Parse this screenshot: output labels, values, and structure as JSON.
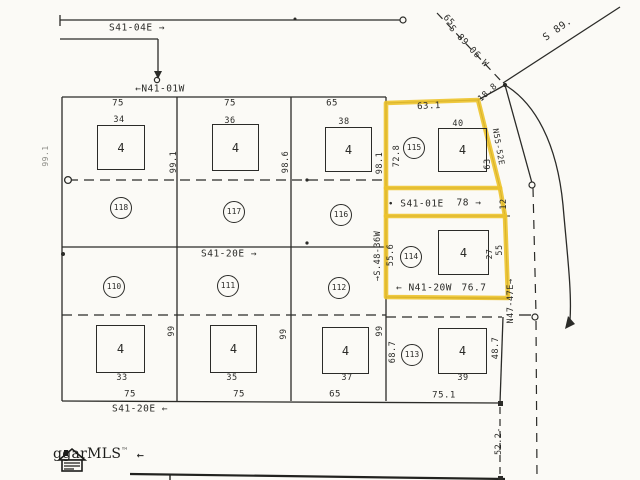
{
  "plat": {
    "colors": {
      "line": "#2b2b28",
      "highlight": "#edc32b",
      "paper": "#fbfaf6",
      "faint": "#8a8a84"
    },
    "logo": {
      "text": "ggarMLS",
      "tm": "™",
      "arrow": "←"
    },
    "street_bearings": {
      "top": "S41-04E →",
      "upper": "←N41-01W",
      "mid_road_dot": "•",
      "mid_road": "S41-01E",
      "mid_road_dist": "78 →",
      "mid": "S41-20E →",
      "lower_road": "← N41-20W",
      "lower_road_dist": "76.7",
      "bottom": "S41-20E ←",
      "ne_dashed": "S 89-06 W",
      "ne_dashed_dist": "65",
      "ne_solid": "S 89.",
      "corner_tie": "18.8",
      "lot115_side": "N55-52E",
      "east_line": "N47-47E→",
      "west114_line": "→S.48-36W",
      "south_tie": "52.2-"
    },
    "labels": [
      {
        "name": "bearing-s41-04e",
        "text": "S41-04E →",
        "x": 137,
        "y": 28,
        "size": 9.5
      },
      {
        "name": "bearing-n41-01w",
        "text": "←N41-01W",
        "x": 160,
        "y": 89,
        "size": 9.5
      },
      {
        "name": "road-dot",
        "text": "•",
        "x": 391,
        "y": 205,
        "size": 9
      },
      {
        "name": "bearing-s41-01e",
        "text": "S41-01E",
        "x": 422,
        "y": 204,
        "size": 9.5
      },
      {
        "name": "dist-78",
        "text": "78 →",
        "x": 469,
        "y": 203,
        "size": 9.5
      },
      {
        "name": "bearing-s41-20e-mid",
        "text": "S41-20E →",
        "x": 229,
        "y": 254,
        "size": 9.5
      },
      {
        "name": "bearing-s41-20e-bottom",
        "text": "S41-20E ←",
        "x": 140,
        "y": 409,
        "size": 9.5
      },
      {
        "name": "bearing-n41-20w",
        "text": "← N41-20W",
        "x": 424,
        "y": 288,
        "size": 9.5
      },
      {
        "name": "dist-76-7",
        "text": "76.7",
        "x": 474,
        "y": 288,
        "size": 9.5
      },
      {
        "name": "bearing-s89-06w",
        "text": "S 89-06 W",
        "x": 468,
        "y": 47,
        "size": 9,
        "rot": 47
      },
      {
        "name": "dist-65-ne",
        "text": "65",
        "x": 448,
        "y": 21,
        "size": 9,
        "rot": 47
      },
      {
        "name": "bearing-s89",
        "text": "S 89.",
        "x": 558,
        "y": 30,
        "size": 10,
        "rot": -35
      },
      {
        "name": "dist-18-8",
        "text": "18.8",
        "x": 488,
        "y": 93,
        "size": 8.5,
        "rot": -42
      },
      {
        "name": "bearing-n55-52e",
        "text": "N55-52E",
        "x": 498,
        "y": 147,
        "size": 8,
        "rot": 80
      },
      {
        "name": "bearing-n47-47e",
        "text": "N47-47E→",
        "x": 511,
        "y": 301,
        "size": 8.5,
        "rot": -90
      },
      {
        "name": "bearing-s48-36w",
        "text": "→S.48-36W",
        "x": 378,
        "y": 256,
        "size": 8.5,
        "rot": -90
      },
      {
        "name": "dist-52-2",
        "text": "52.2-",
        "x": 499,
        "y": 441,
        "size": 8.5,
        "rot": -90
      },
      {
        "name": "dim-75-a",
        "text": "75",
        "x": 118,
        "y": 104,
        "size": 9
      },
      {
        "name": "dim-75-b",
        "text": "75",
        "x": 230,
        "y": 104,
        "size": 9
      },
      {
        "name": "dim-65-a",
        "text": "65",
        "x": 332,
        "y": 104,
        "size": 9
      },
      {
        "name": "dim-63-1",
        "text": "63.1",
        "x": 429,
        "y": 107,
        "size": 9,
        "rot": -3
      },
      {
        "name": "house-34",
        "text": "34",
        "x": 119,
        "y": 120,
        "size": 8.5
      },
      {
        "name": "house-36",
        "text": "36",
        "x": 230,
        "y": 121,
        "size": 8.5
      },
      {
        "name": "house-38",
        "text": "38",
        "x": 344,
        "y": 122,
        "size": 8.5
      },
      {
        "name": "house-40",
        "text": "40",
        "x": 458,
        "y": 124,
        "size": 8.5
      },
      {
        "name": "dim-99-1",
        "text": "99.1",
        "x": 174,
        "y": 162,
        "size": 8.5,
        "rot": -90
      },
      {
        "name": "dim-98-6",
        "text": "98.6",
        "x": 286,
        "y": 162,
        "size": 8.5,
        "rot": -90
      },
      {
        "name": "dim-98-1",
        "text": "98.1",
        "x": 380,
        "y": 163,
        "size": 8.5,
        "rot": -90
      },
      {
        "name": "dim-72-8",
        "text": "72.8",
        "x": 397,
        "y": 156,
        "size": 8.5,
        "rot": -90
      },
      {
        "name": "dim-99-1-west",
        "text": "99.1",
        "x": 46,
        "y": 156,
        "size": 8,
        "rot": -90,
        "color": "#8a8a84"
      },
      {
        "name": "dim-63",
        "text": "63",
        "x": 488,
        "y": 164,
        "size": 8.5,
        "rot": -90
      },
      {
        "name": "dim-12",
        "text": "12",
        "x": 504,
        "y": 204,
        "size": 8.5,
        "rot": -90
      },
      {
        "name": "dim-55-6",
        "text": "55.6",
        "x": 391,
        "y": 255,
        "size": 8.5,
        "rot": -90
      },
      {
        "name": "dim-27",
        "text": "27",
        "x": 490,
        "y": 254,
        "size": 8,
        "rot": -90
      },
      {
        "name": "dim-55",
        "text": "55",
        "x": 500,
        "y": 250,
        "size": 8.5,
        "rot": -90
      },
      {
        "name": "dim-99-a",
        "text": "99",
        "x": 172,
        "y": 331,
        "size": 8.5,
        "rot": -90
      },
      {
        "name": "dim-99-b",
        "text": "99",
        "x": 284,
        "y": 334,
        "size": 8.5,
        "rot": -90
      },
      {
        "name": "dim-99-c",
        "text": "99",
        "x": 380,
        "y": 331,
        "size": 8.5,
        "rot": -90
      },
      {
        "name": "dim-68-7",
        "text": "68.7",
        "x": 393,
        "y": 352,
        "size": 8.5,
        "rot": -90
      },
      {
        "name": "dim-48-7",
        "text": "48.7",
        "x": 496,
        "y": 348,
        "size": 8.5,
        "rot": -90
      },
      {
        "name": "house-33",
        "text": "33",
        "x": 122,
        "y": 378,
        "size": 8.5
      },
      {
        "name": "house-35",
        "text": "35",
        "x": 232,
        "y": 378,
        "size": 8.5
      },
      {
        "name": "house-37",
        "text": "37",
        "x": 347,
        "y": 378,
        "size": 8.5
      },
      {
        "name": "house-39",
        "text": "39",
        "x": 463,
        "y": 378,
        "size": 8.5
      },
      {
        "name": "dim-75-c",
        "text": "75",
        "x": 130,
        "y": 395,
        "size": 9
      },
      {
        "name": "dim-75-d",
        "text": "75",
        "x": 239,
        "y": 395,
        "size": 9
      },
      {
        "name": "dim-65-b",
        "text": "65",
        "x": 335,
        "y": 395,
        "size": 9
      },
      {
        "name": "dim-75-1",
        "text": "75.1",
        "x": 444,
        "y": 396,
        "size": 9
      }
    ],
    "lot_circles": [
      {
        "num": "115",
        "x": 414,
        "y": 148,
        "r": 10
      },
      {
        "num": "118",
        "x": 121,
        "y": 208,
        "r": 10
      },
      {
        "num": "117",
        "x": 234,
        "y": 212,
        "r": 10
      },
      {
        "num": "116",
        "x": 341,
        "y": 215,
        "r": 10
      },
      {
        "num": "114",
        "x": 411,
        "y": 257,
        "r": 10
      },
      {
        "num": "110",
        "x": 114,
        "y": 287,
        "r": 10
      },
      {
        "num": "111",
        "x": 228,
        "y": 286,
        "r": 10
      },
      {
        "num": "112",
        "x": 339,
        "y": 288,
        "r": 10
      },
      {
        "num": "113",
        "x": 412,
        "y": 355,
        "r": 10
      }
    ],
    "buildings": [
      {
        "label": "4",
        "x": 97,
        "y": 125,
        "w": 46,
        "h": 43
      },
      {
        "label": "4",
        "x": 212,
        "y": 124,
        "w": 45,
        "h": 45
      },
      {
        "label": "4",
        "x": 325,
        "y": 127,
        "w": 45,
        "h": 43
      },
      {
        "label": "4",
        "x": 438,
        "y": 128,
        "w": 47,
        "h": 42
      },
      {
        "label": "4",
        "x": 438,
        "y": 230,
        "w": 49,
        "h": 43
      },
      {
        "label": "4",
        "x": 96,
        "y": 325,
        "w": 47,
        "h": 46
      },
      {
        "label": "4",
        "x": 210,
        "y": 325,
        "w": 45,
        "h": 46
      },
      {
        "label": "4",
        "x": 322,
        "y": 327,
        "w": 45,
        "h": 45
      },
      {
        "label": "4",
        "x": 438,
        "y": 328,
        "w": 47,
        "h": 44
      }
    ]
  }
}
